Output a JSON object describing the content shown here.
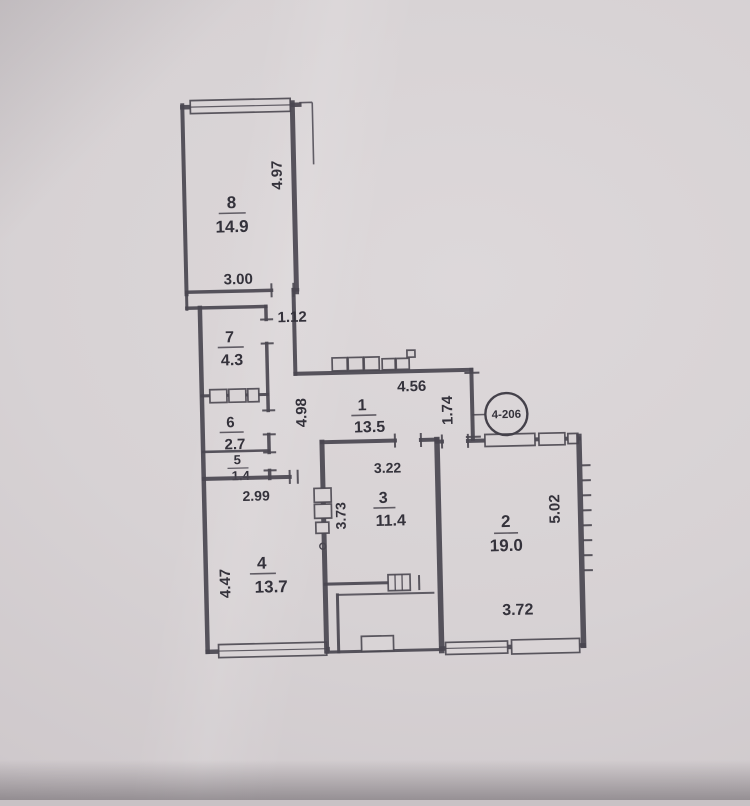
{
  "document": {
    "type_label": "apartment floor plan (photo of paper drawing)"
  },
  "stamp": {
    "label": "4-206"
  },
  "rooms": {
    "r8": {
      "number": "8",
      "area": "14.9"
    },
    "r7": {
      "number": "7",
      "area": "4.3"
    },
    "r6": {
      "number": "6",
      "area": "2.7"
    },
    "r5": {
      "number": "5",
      "area": "1.4"
    },
    "r4": {
      "number": "4",
      "area": "13.7"
    },
    "r1": {
      "number": "1",
      "area": "13.5"
    },
    "r3": {
      "number": "3",
      "area": "11.4"
    },
    "r2": {
      "number": "2",
      "area": "19.0"
    }
  },
  "dims": {
    "r8_height": "4.97",
    "r8_width": "3.00",
    "hall_neck": "1.12",
    "corridor_len": "4.98",
    "r1_width": "4.56",
    "r1_depth": "1.74",
    "r3_width": "3.22",
    "r3_height": "3.73",
    "r4_width": "2.99",
    "r4_height": "4.47",
    "r2_height": "5.02",
    "r2_width": "3.72"
  }
}
